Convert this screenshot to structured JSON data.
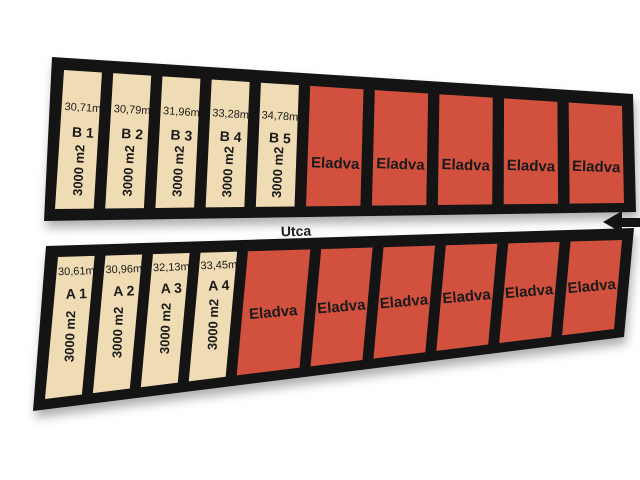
{
  "map": {
    "street_label": "Utca",
    "sold_label": "Eladva",
    "colors": {
      "available_fill": "#f0dcb4",
      "sold_fill": "#d1503e",
      "border": "#141414",
      "street": "#ffffff",
      "text": "#1a1a1a"
    },
    "rows": [
      {
        "side": "top",
        "plots": [
          {
            "id": "B 1",
            "frontage": "30,71m",
            "area": "3000 m2",
            "status": "available"
          },
          {
            "id": "B 2",
            "frontage": "30,79m",
            "area": "3000 m2",
            "status": "available"
          },
          {
            "id": "B 3",
            "frontage": "31,96m",
            "area": "3000 m2",
            "status": "available"
          },
          {
            "id": "B 4",
            "frontage": "33,28m",
            "area": "3000 m2",
            "status": "available"
          },
          {
            "id": "B 5",
            "frontage": "34,78m",
            "area": "3000 m2",
            "status": "available"
          },
          {
            "status": "sold"
          },
          {
            "status": "sold"
          },
          {
            "status": "sold"
          },
          {
            "status": "sold"
          },
          {
            "status": "sold"
          }
        ]
      },
      {
        "side": "bottom",
        "plots": [
          {
            "id": "A 1",
            "frontage": "30,61m",
            "area": "3000 m2",
            "status": "available"
          },
          {
            "id": "A 2",
            "frontage": "30,96m",
            "area": "3000 m2",
            "status": "available"
          },
          {
            "id": "A 3",
            "frontage": "32,13m",
            "area": "3000 m2",
            "status": "available"
          },
          {
            "id": "A 4",
            "frontage": "33,45m",
            "area": "3000 m2",
            "status": "available"
          },
          {
            "status": "sold"
          },
          {
            "status": "sold"
          },
          {
            "status": "sold"
          },
          {
            "status": "sold"
          },
          {
            "status": "sold"
          },
          {
            "status": "sold"
          }
        ]
      }
    ],
    "arrow": {
      "direction": "left"
    }
  }
}
